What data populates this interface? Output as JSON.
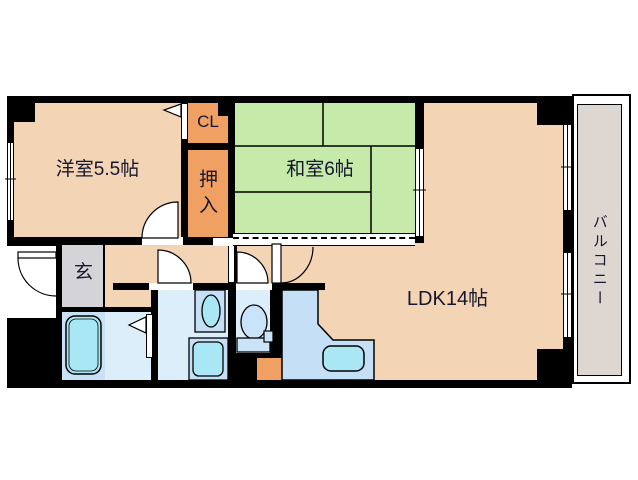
{
  "floorplan": {
    "rooms": {
      "western_room": {
        "label": "洋室5.5帖"
      },
      "closet": {
        "label": "CL"
      },
      "oshiire": {
        "label": "押入"
      },
      "japanese_room": {
        "label": "和室6帖"
      },
      "ldk": {
        "label": "LDK14帖"
      },
      "entrance": {
        "label": "玄"
      },
      "balcony": {
        "label": "バルコニー"
      }
    },
    "colors": {
      "floor_peach": "#f3d5b5",
      "closet_orange": "#efa062",
      "tatami_green": "#c5eaa9",
      "balcony_gray": "#ded6d0",
      "entrance_gray": "#d4d4d8",
      "wet_floor_blue": "#ddeefb",
      "bath_floor_blue": "#c9e1f7",
      "fixture_blue": "#c5dff6",
      "fixture_cyan": "#a9e7f4",
      "toilet_blue": "#c9e3f8",
      "wall_black": "#000000",
      "text_dark": "#16162e"
    }
  }
}
